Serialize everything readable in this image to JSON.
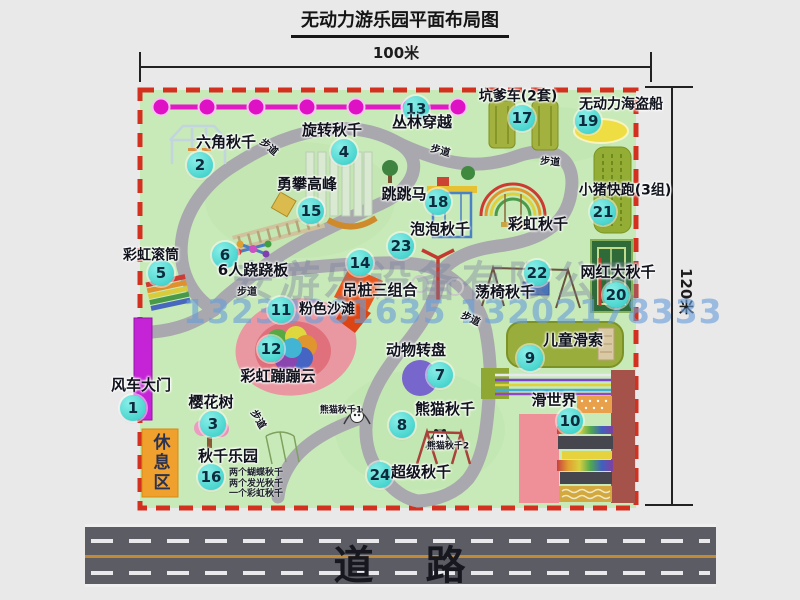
{
  "title": "无动力游乐园平面布局图",
  "dims": {
    "width": "100米",
    "height": "120米"
  },
  "watermark": {
    "company": "安游乐设备有限公司",
    "phone": "13233861635 13202178333"
  },
  "road_label": "道 路",
  "rest_area": "休息区",
  "attractions": [
    {
      "num": "1",
      "name": "风车大门",
      "cx": 133,
      "cy": 408,
      "lx": 141,
      "ly": 386,
      "fs": 15
    },
    {
      "num": "2",
      "name": "六角秋千",
      "cx": 200,
      "cy": 165,
      "lx": 226,
      "ly": 143,
      "fs": 15
    },
    {
      "num": "3",
      "name": "樱花树",
      "cx": 213,
      "cy": 424,
      "lx": 211,
      "ly": 403,
      "fs": 15
    },
    {
      "num": "4",
      "name": "旋转秋千",
      "cx": 344,
      "cy": 152,
      "lx": 332,
      "ly": 131,
      "fs": 15
    },
    {
      "num": "5",
      "name": "彩虹滚筒",
      "cx": 161,
      "cy": 273,
      "lx": 151,
      "ly": 256,
      "fs": 14
    },
    {
      "num": "6",
      "name": "6人跷跷板",
      "cx": 225,
      "cy": 255,
      "lx": 253,
      "ly": 271,
      "fs": 15
    },
    {
      "num": "7",
      "name": "动物转盘",
      "cx": 440,
      "cy": 375,
      "lx": 416,
      "ly": 351,
      "fs": 15
    },
    {
      "num": "8",
      "name": "熊猫秋千",
      "cx": 402,
      "cy": 425,
      "lx": 445,
      "ly": 410,
      "fs": 15
    },
    {
      "num": "9",
      "name": "儿童滑索",
      "cx": 530,
      "cy": 358,
      "lx": 573,
      "ly": 341,
      "fs": 15
    },
    {
      "num": "10",
      "name": "滑世界",
      "cx": 570,
      "cy": 421,
      "lx": 554,
      "ly": 401,
      "fs": 15
    },
    {
      "num": "11",
      "name": "粉色沙滩",
      "cx": 281,
      "cy": 310,
      "lx": 327,
      "ly": 310,
      "fs": 14
    },
    {
      "num": "12",
      "name": "彩虹蹦蹦云",
      "cx": 271,
      "cy": 349,
      "lx": 278,
      "ly": 377,
      "fs": 15
    },
    {
      "num": "13",
      "name": "丛林穿越",
      "cx": 416,
      "cy": 109,
      "lx": 422,
      "ly": 123,
      "fs": 15
    },
    {
      "num": "14",
      "name": "吊桩三组合",
      "cx": 360,
      "cy": 263,
      "lx": 380,
      "ly": 291,
      "fs": 15
    },
    {
      "num": "15",
      "name": "勇攀高峰",
      "cx": 311,
      "cy": 211,
      "lx": 307,
      "ly": 185,
      "fs": 15
    },
    {
      "num": "16",
      "name": "秋千乐园",
      "cx": 211,
      "cy": 477,
      "lx": 228,
      "ly": 457,
      "fs": 15
    },
    {
      "num": "17",
      "name": "坑爹车(2套)",
      "cx": 522,
      "cy": 118,
      "lx": 518,
      "ly": 97,
      "fs": 14
    },
    {
      "num": "18",
      "name": "跳跳马",
      "cx": 438,
      "cy": 202,
      "lx": 404,
      "ly": 195,
      "fs": 15
    },
    {
      "num": "19",
      "name": "无动力海盗船",
      "cx": 588,
      "cy": 121,
      "lx": 621,
      "ly": 105,
      "fs": 14
    },
    {
      "num": "20",
      "name": "网红大秋千",
      "cx": 616,
      "cy": 295,
      "lx": 618,
      "ly": 273,
      "fs": 15
    },
    {
      "num": "21",
      "name": "小猪快跑(3组)",
      "cx": 603,
      "cy": 212,
      "lx": 625,
      "ly": 191,
      "fs": 14
    },
    {
      "num": "22",
      "name": "荡椅秋千",
      "cx": 537,
      "cy": 273,
      "lx": 505,
      "ly": 293,
      "fs": 15
    },
    {
      "num": "23",
      "name": "泡泡秋千",
      "cx": 401,
      "cy": 246,
      "lx": 440,
      "ly": 230,
      "fs": 15
    },
    {
      "num": "24",
      "name": "超级秋千",
      "cx": 380,
      "cy": 475,
      "lx": 421,
      "ly": 473,
      "fs": 15
    }
  ],
  "extra_labels": [
    {
      "text": "彩虹秋千",
      "x": 538,
      "y": 225,
      "fs": 15,
      "rot": 0,
      "name": "rainbow-swing-label"
    },
    {
      "text": "熊猫秋千1",
      "x": 341,
      "y": 411,
      "fs": 9,
      "rot": 0,
      "name": "panda-swing-1-label"
    },
    {
      "text": "熊猫秋千2",
      "x": 448,
      "y": 447,
      "fs": 9,
      "rot": 0,
      "name": "panda-swing-2-label"
    },
    {
      "text": "步道",
      "x": 268,
      "y": 148,
      "fs": 10,
      "rot": 40,
      "name": "walkway-label"
    },
    {
      "text": "步道",
      "x": 440,
      "y": 152,
      "fs": 10,
      "rot": 15,
      "name": "walkway-label"
    },
    {
      "text": "步道",
      "x": 550,
      "y": 163,
      "fs": 10,
      "rot": 5,
      "name": "walkway-label"
    },
    {
      "text": "步道",
      "x": 247,
      "y": 293,
      "fs": 10,
      "rot": 0,
      "name": "walkway-label"
    },
    {
      "text": "步道",
      "x": 470,
      "y": 320,
      "fs": 10,
      "rot": 25,
      "name": "walkway-label"
    },
    {
      "text": "步道",
      "x": 257,
      "y": 420,
      "fs": 10,
      "rot": 60,
      "name": "walkway-label"
    }
  ],
  "swing_park_notes": [
    "两个蝴蝶秋千",
    "两个发光秋千",
    "一个彩虹秋千"
  ]
}
